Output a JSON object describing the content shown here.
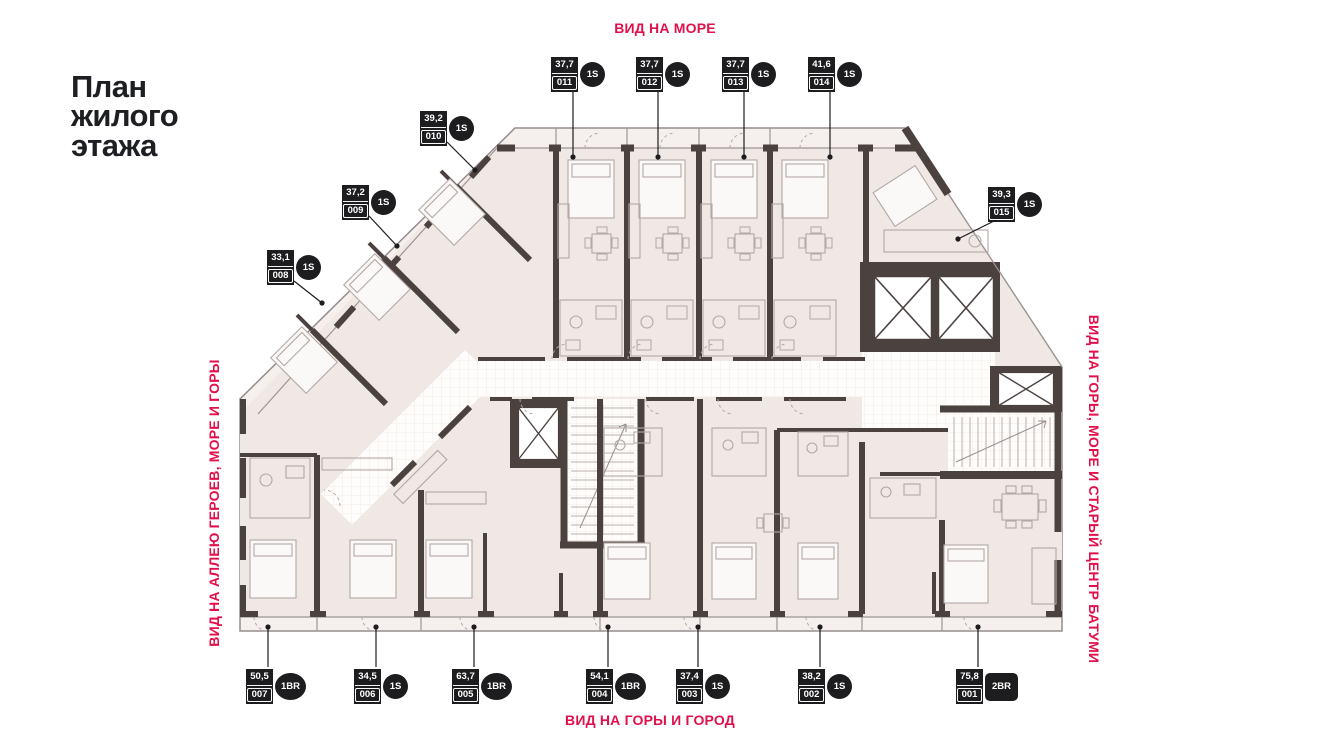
{
  "title": {
    "lines": [
      "План",
      "жилого",
      "этажа"
    ]
  },
  "views": {
    "top": "ВИД НА МОРЕ",
    "bottom": "ВИД НА ГОРЫ И ГОРОД",
    "left": "ВИД НА АЛЛЕЮ ГЕРОЕВ, МОРЕ И ГОРЫ",
    "right": "ВИД НА ГОРЫ, МОРЕ И СТАРЫЙ ЦЕНТР БАТУМИ"
  },
  "colors": {
    "accent": "#e1104b",
    "badge_bg": "#1d1c1e",
    "wall": "#4b4240",
    "unit_fill": "#efe8e5",
    "balcony_fill": "#f5f0ed"
  },
  "units": [
    {
      "number": "011",
      "area": "37,7",
      "type": "1S",
      "badge": [
        551,
        57
      ],
      "leader": [
        573,
        89,
        573,
        157
      ]
    },
    {
      "number": "012",
      "area": "37,7",
      "type": "1S",
      "badge": [
        636,
        57
      ],
      "leader": [
        658,
        89,
        658,
        157
      ]
    },
    {
      "number": "013",
      "area": "37,7",
      "type": "1S",
      "badge": [
        722,
        57
      ],
      "leader": [
        744,
        89,
        744,
        157
      ]
    },
    {
      "number": "014",
      "area": "41,6",
      "type": "1S",
      "badge": [
        808,
        57
      ],
      "leader": [
        830,
        89,
        830,
        157
      ]
    },
    {
      "number": "010",
      "area": "39,2",
      "type": "1S",
      "badge": [
        420,
        111
      ],
      "leader": [
        447,
        142,
        475,
        170
      ]
    },
    {
      "number": "009",
      "area": "37,2",
      "type": "1S",
      "badge": [
        342,
        185
      ],
      "leader": [
        369,
        216,
        397,
        246
      ]
    },
    {
      "number": "008",
      "area": "33,1",
      "type": "1S",
      "badge": [
        267,
        250
      ],
      "leader": [
        294,
        281,
        322,
        303
      ]
    },
    {
      "number": "015",
      "area": "39,3",
      "type": "1S",
      "badge": [
        988,
        187
      ],
      "leader": [
        1000,
        218,
        958,
        239
      ]
    },
    {
      "number": "007",
      "area": "50,5",
      "type": "1BR",
      "badge": [
        246,
        669
      ],
      "leader": [
        268,
        667,
        268,
        627
      ]
    },
    {
      "number": "006",
      "area": "34,5",
      "type": "1S",
      "badge": [
        354,
        669
      ],
      "leader": [
        376,
        667,
        376,
        627
      ]
    },
    {
      "number": "005",
      "area": "63,7",
      "type": "1BR",
      "badge": [
        452,
        669
      ],
      "leader": [
        474,
        667,
        474,
        627
      ]
    },
    {
      "number": "004",
      "area": "54,1",
      "type": "1BR",
      "badge": [
        586,
        669
      ],
      "leader": [
        608,
        667,
        608,
        627
      ]
    },
    {
      "number": "003",
      "area": "37,4",
      "type": "1S",
      "badge": [
        676,
        669
      ],
      "leader": [
        698,
        667,
        698,
        627
      ]
    },
    {
      "number": "002",
      "area": "38,2",
      "type": "1S",
      "badge": [
        798,
        669
      ],
      "leader": [
        820,
        667,
        820,
        627
      ]
    },
    {
      "number": "001",
      "area": "75,8",
      "type": "2BR",
      "badge": [
        956,
        669
      ],
      "leader": [
        978,
        667,
        978,
        627
      ]
    }
  ]
}
